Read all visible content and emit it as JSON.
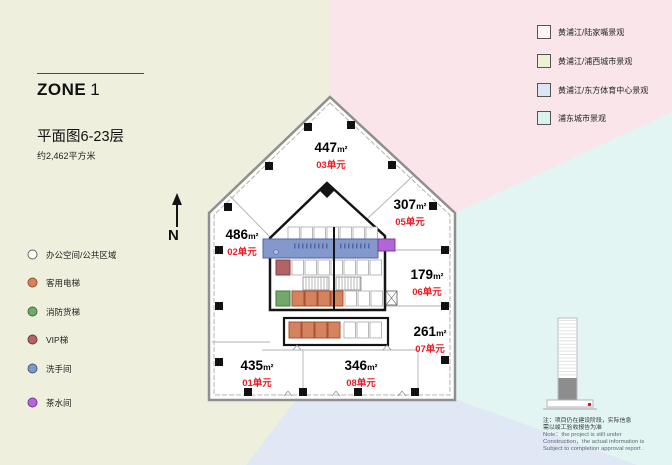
{
  "title": {
    "zone_word": "ZONE",
    "zone_num": "1",
    "plan": "平面图6-23层",
    "area_total": "约2,462平方米"
  },
  "north_label": "N",
  "space_legend": {
    "items": [
      {
        "label": "办公空间/公共区域",
        "color": "#ffffff"
      },
      {
        "label": "客用电梯",
        "color": "#d5825f"
      },
      {
        "label": "消防货梯",
        "color": "#72a96a"
      },
      {
        "label": "VIP梯",
        "color": "#b26366"
      },
      {
        "label": "洗手间",
        "color": "#8097c2"
      },
      {
        "label": "茶水间",
        "color": "#b368d3"
      }
    ]
  },
  "view_legend": {
    "items": [
      {
        "label": "黄浦江/陆家嘴景观",
        "color": "#fdf3f5"
      },
      {
        "label": "黄浦江/浦西城市景观",
        "color": "#edf2d6"
      },
      {
        "label": "黄浦江/东方体育中心景观",
        "color": "#dce6f3"
      },
      {
        "label": "浦东城市景观",
        "color": "#daf1ee"
      }
    ]
  },
  "sqm": "m²",
  "units": [
    {
      "num": "01单元",
      "area": "435"
    },
    {
      "num": "02单元",
      "area": "486"
    },
    {
      "num": "03单元",
      "area": "447"
    },
    {
      "num": "05单元",
      "area": "307"
    },
    {
      "num": "06单元",
      "area": "179"
    },
    {
      "num": "07单元",
      "area": "261"
    },
    {
      "num": "08单元",
      "area": "346"
    }
  ],
  "note": {
    "zh1": "注：项目仍在建设阶段，实际信息",
    "zh2": "需以竣工验收报告为准",
    "en1": "Note：the project is still under",
    "en2": "Construction，the actual information is",
    "en3": "Subject to completion approval report ."
  },
  "colors": {
    "bg_west_green": "#eef0dd",
    "bg_northeast_pink": "#fae5ea",
    "bg_east_cyan": "#e2f5f3",
    "bg_south_lavender": "#e0e7f5",
    "unit_number_red": "#ee1c25",
    "restroom_blue": "#8598cb"
  }
}
